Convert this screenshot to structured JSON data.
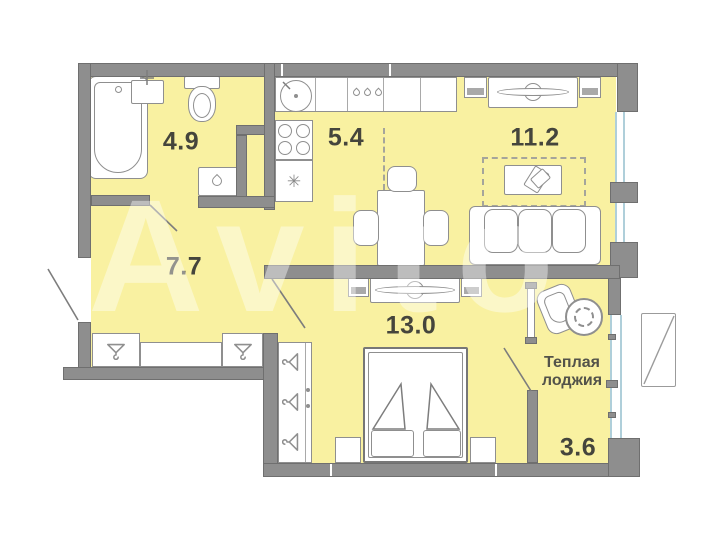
{
  "watermark_text": "Avito",
  "rooms": {
    "bathroom": {
      "area": "4.9"
    },
    "kitchen": {
      "area": "5.4"
    },
    "living": {
      "area": "11.2"
    },
    "hallway": {
      "area": "7.7"
    },
    "bedroom": {
      "area": "13.0"
    },
    "loggia": {
      "area": "3.6",
      "name_line1": "Теплая",
      "name_line2": "лоджия"
    }
  },
  "icons": {
    "fridge_snowflake_glyph": "✳",
    "names": [
      "bathtub-icon",
      "bath-sink-icon",
      "toilet-icon",
      "washing-machine-icon",
      "laundry-basket-icon",
      "kitchen-sink-icon",
      "stove-icon",
      "fridge-icon",
      "drawer-handles-icon",
      "dining-table",
      "chair",
      "tv-stand",
      "tv-icon",
      "coffee-table",
      "magazine-icon",
      "sofa",
      "wardrobe",
      "hanger-icon",
      "bed",
      "pillow",
      "nightstand",
      "shoe-cabinet",
      "door-swing",
      "window",
      "ac-basket"
    ]
  },
  "colors": {
    "floor": "#F9F1A1",
    "wall": "#8E8E8E",
    "window_glass": "#AFCFDA",
    "label_text": "#45453C",
    "furniture_stroke": "#8F8F8F"
  }
}
